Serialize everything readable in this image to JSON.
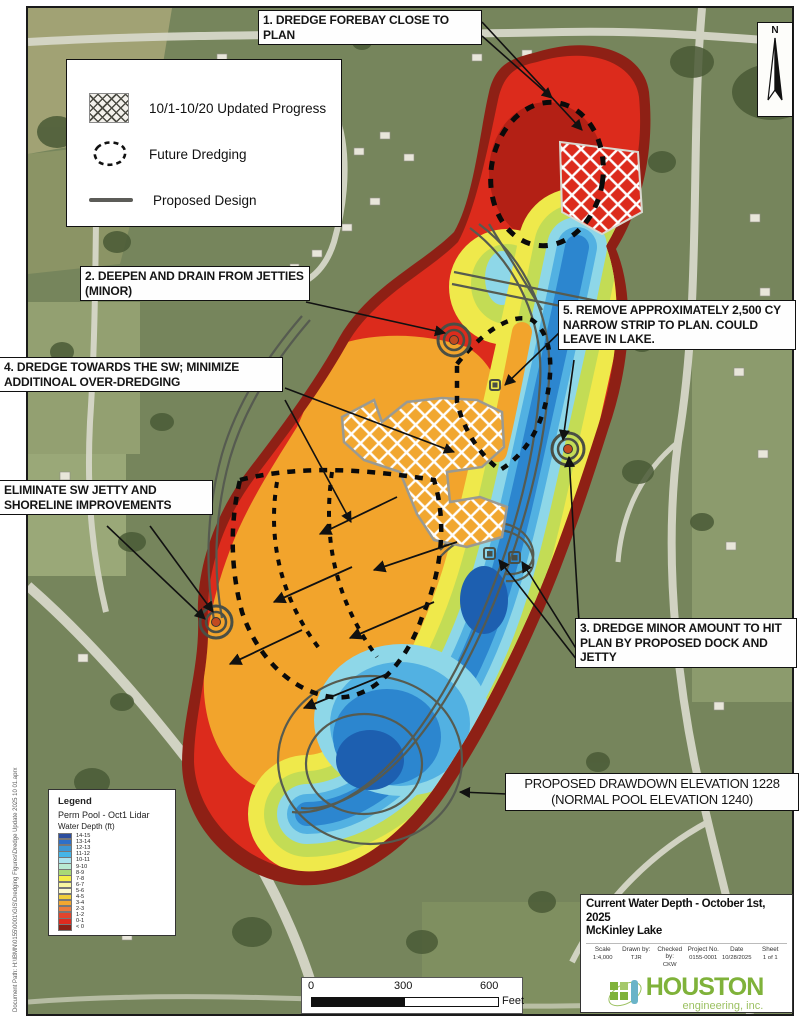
{
  "document": {
    "doc_path": "Document Path: H:\\IBMN\\0155\\0001\\GIS\\Dredging Figures\\Dredge Update 2025 10 01.aprx",
    "north_label": "N"
  },
  "map_legend": {
    "items": [
      {
        "symbol": "crosshatch-swatch",
        "label": "10/1-10/20 Updated Progress"
      },
      {
        "symbol": "dashed-outline-swatch",
        "label": "Future Dredging"
      },
      {
        "symbol": "gray-line-swatch",
        "label": "Proposed Design"
      }
    ]
  },
  "callouts": {
    "c1": "1. DREDGE FOREBAY CLOSE TO PLAN",
    "c2": "2. DEEPEN AND DRAIN FROM JETTIES (MINOR)",
    "c3": "3. DREDGE MINOR AMOUNT TO HIT PLAN BY PROPOSED DOCK AND JETTY",
    "c4": "4. DREDGE TOWARDS THE SW; MINIMIZE ADDITINOAL OVER-DREDGING",
    "c5": "5. REMOVE APPROXIMATELY 2,500 CY NARROW STRIP TO PLAN. COULD LEAVE IN LAKE.",
    "c6": "ELIMINATE SW JETTY AND SHORELINE IMPROVEMENTS",
    "drawdown": "PROPOSED DRAWDOWN ELEVATION 1228 (NORMAL POOL ELEVATION 1240)"
  },
  "depth_legend": {
    "title": "Legend",
    "layer": "Perm Pool - Oct1 Lidar",
    "field": "Water Depth (ft)",
    "classes": [
      {
        "label": "14-15",
        "color": "#2c4d9e"
      },
      {
        "label": "13-14",
        "color": "#2e6fc8"
      },
      {
        "label": "12-13",
        "color": "#3e97d3"
      },
      {
        "label": "11-12",
        "color": "#45b5e7"
      },
      {
        "label": "10-11",
        "color": "#abe3ee"
      },
      {
        "label": "9-10",
        "color": "#b9ead3"
      },
      {
        "label": "8-9",
        "color": "#a9d977"
      },
      {
        "label": "7-8",
        "color": "#f4ee49"
      },
      {
        "label": "6-7",
        "color": "#f9f6a1"
      },
      {
        "label": "5-6",
        "color": "#fcfacd"
      },
      {
        "label": "4-5",
        "color": "#f1ce3a"
      },
      {
        "label": "3-4",
        "color": "#f1a730"
      },
      {
        "label": "2-3",
        "color": "#eb7a3b"
      },
      {
        "label": "1-2",
        "color": "#e3452c"
      },
      {
        "label": "0-1",
        "color": "#e02a1e"
      },
      {
        "label": "< 0",
        "color": "#8c2015"
      }
    ]
  },
  "scale_bar": {
    "tick0": "0",
    "tick300": "300",
    "tick600": "600",
    "unit": "Feet"
  },
  "title_block": {
    "title_line1": "Current Water Depth - October 1st, 2025",
    "title_line2": "McKinley Lake",
    "fields": [
      {
        "label": "Scale",
        "value": "1:4,000"
      },
      {
        "label": "Drawn by:",
        "value": "TJR"
      },
      {
        "label": "Checked by:",
        "value": "CKW"
      },
      {
        "label": "Project No.",
        "value": "0155-0001"
      },
      {
        "label": "Date",
        "value": "10/28/2025"
      },
      {
        "label": "Sheet",
        "value": "1 of 1"
      }
    ],
    "logo": {
      "name": "HOUSTON",
      "sub": "engineering, inc.",
      "color": "#7fb23a"
    }
  }
}
